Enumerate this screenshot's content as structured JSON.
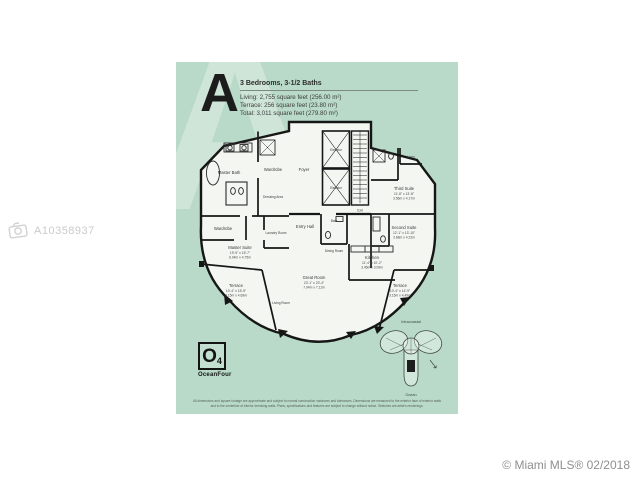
{
  "page": {
    "mls_watermark": "A10358937",
    "credit": "© Miami MLS® 02/2018"
  },
  "header": {
    "plan_letter": "A",
    "bedrooms_baths": "3 Bedrooms, 3-1/2 Baths",
    "living": "Living: 2,755 square feet (256.00 m²)",
    "terrace": "Terrace: 256 square feet (23.80 m²)",
    "total": "Total: 3,011 square feet (279.80 m²)"
  },
  "plan": {
    "rooms": {
      "master_bath": "Master Bath",
      "wardrobe_top": "Wardrobe",
      "dressing_area": "Dressing Area",
      "wardrobe_left": "Wardrobe",
      "laundry_room": "Laundry Room",
      "foyer": "Foyer",
      "elevator": "Elevator",
      "exit": "Exit",
      "linen": "Linen",
      "bath": "Bath",
      "entry_hall": "Entry Hall",
      "dining_room": "Dining Room",
      "living_room": "Living Room",
      "third_suite": {
        "name": "Third Suite",
        "dim_ft": "11'-8\" x 13'-8\"",
        "dim_m": "3.56m x 4.17m"
      },
      "second_suite": {
        "name": "Second Suite",
        "dim_ft": "12'-1\" x 13'-10\"",
        "dim_m": "3.68m x 4.22m"
      },
      "kitchen": {
        "name": "Kitchen",
        "dim_ft": "11'-4\" x 10'-2\"",
        "dim_m": "3.45m x 3.09m"
      },
      "master_suite": {
        "name": "Master Suite",
        "dim_ft": "19'-9\" x 15'-7\"",
        "dim_m": "6.04m x 4.75m"
      },
      "great_room": {
        "name": "Great Room",
        "dim_ft": "23'-1\" x 23'-4\"",
        "dim_m": "7.04m x 7.11m"
      },
      "terrace_left": {
        "name": "Terrace",
        "dim_ft": "10'-4\" x 15'-5\"",
        "dim_m": "3.15m x 4.69m"
      },
      "terrace_right": {
        "name": "Terrace",
        "dim_ft": "10'-4\" x 14'-9\"",
        "dim_m": "3.15m x 4.49m"
      }
    },
    "keyplan": {
      "top_label": "Intracoastal",
      "bottom_label": "Ocean"
    },
    "logo": {
      "mark": "O",
      "sub": "4",
      "name": "OceanFour"
    },
    "disclaimer_line1": "All dimensions and square footage are approximate and subject to normal construction variances and tolerances. Dimensions are measured to the exterior face of exterior walls",
    "disclaimer_line2": "and to the centerline of interior demising walls. Plans, specifications and features are subject to change without notice. Sketches are artist's renderings."
  },
  "colors": {
    "sheet": "#b9dac8",
    "walls": "#161616",
    "plan_fill": "#f4f6f1"
  }
}
